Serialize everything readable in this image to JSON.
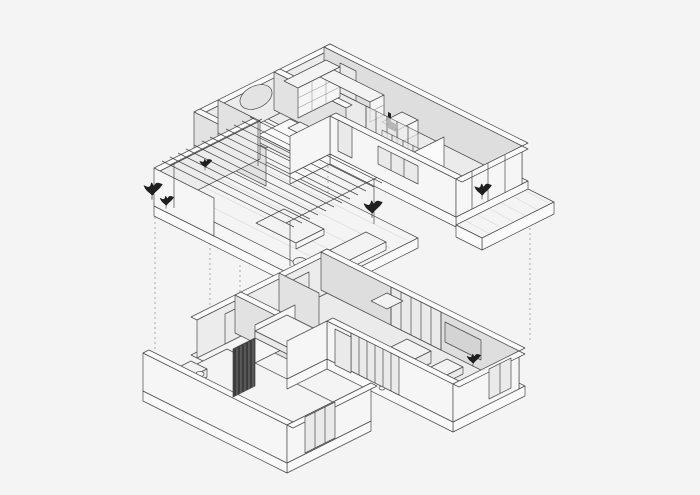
{
  "title": "Two-level apartment axonometric cutaway drawing",
  "colors": {
    "background": "#f4f4f4",
    "line": "#4a4a4a",
    "lineLight": "#9a9a9a",
    "wallTop": "#fbfbfb",
    "wallInner": "#dedede",
    "wallBack": "#ececec",
    "wallMid": "#e2e2e2",
    "wallOuter": "#f6f6f6",
    "floor": "#f4f4f4",
    "floorInner": "#ebebeb",
    "slabEdge": "#fafafa",
    "glass": "#eaeaea",
    "furniture": "#f3f3f3",
    "accentDark": "#1f1f1f",
    "slats": "#3d3d3d",
    "tv": "#d4d4d4",
    "arch": "#d6d6d6",
    "deckLine": "#d9d9d9"
  },
  "scene": {
    "type": "axonometric architectural drawing of a two-storey apartment, exploded cutaway view",
    "upper_floor": {
      "name": "upper floor",
      "elements": [
        "roof terrace with timber pergola",
        "potted plants",
        "outdoor lounge bench and daybed",
        "bedroom with round wall mirror",
        "arched headboard wall",
        "double bed",
        "walk-in closet shelving",
        "dresser",
        "study desk with chair",
        "glass partitions",
        "bathroom with toilet",
        "balcony strip with floor tiles"
      ]
    },
    "lower_floor": {
      "name": "lower floor",
      "elements": [
        "entry hall",
        "bathroom with vanity counter",
        "dark wood slat screen",
        "small bedroom",
        "corridor partitions",
        "kitchen island",
        "dining table with chairs",
        "sectional sofa",
        "round coffee tables",
        "TV wall panel",
        "full-height glazed windows with mullions",
        "glass doors"
      ]
    },
    "projection_lines": {
      "style": "dotted vertical guides between floors",
      "count": 5
    }
  }
}
